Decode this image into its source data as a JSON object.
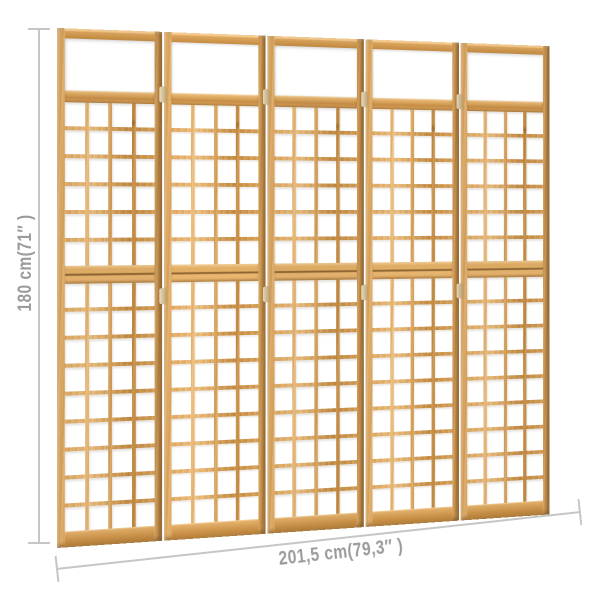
{
  "product": {
    "name": "5-panel wood trellis room divider",
    "panel_count": 5,
    "panel_structure": {
      "columns": 4,
      "upper_grid_rows": 6,
      "lower_grid_rows": 9,
      "has_top_window": true,
      "halves": 2
    }
  },
  "annotations": {
    "height": {
      "label": "180 cm(71″ )",
      "value_cm": "180",
      "value_in": "71"
    },
    "width": {
      "label": "201,5 cm(79,3″ )",
      "value_cm": "201,5",
      "value_in": "79,3"
    }
  },
  "colors": {
    "wood_light": "#e6b878",
    "wood_mid": "#d7a25c",
    "wood_deep": "#c08840",
    "wood_shadow": "#8a6230",
    "dim_line": "#c6c6c6",
    "dim_text": "#9b9b9b",
    "page_bg": "#ffffff"
  }
}
